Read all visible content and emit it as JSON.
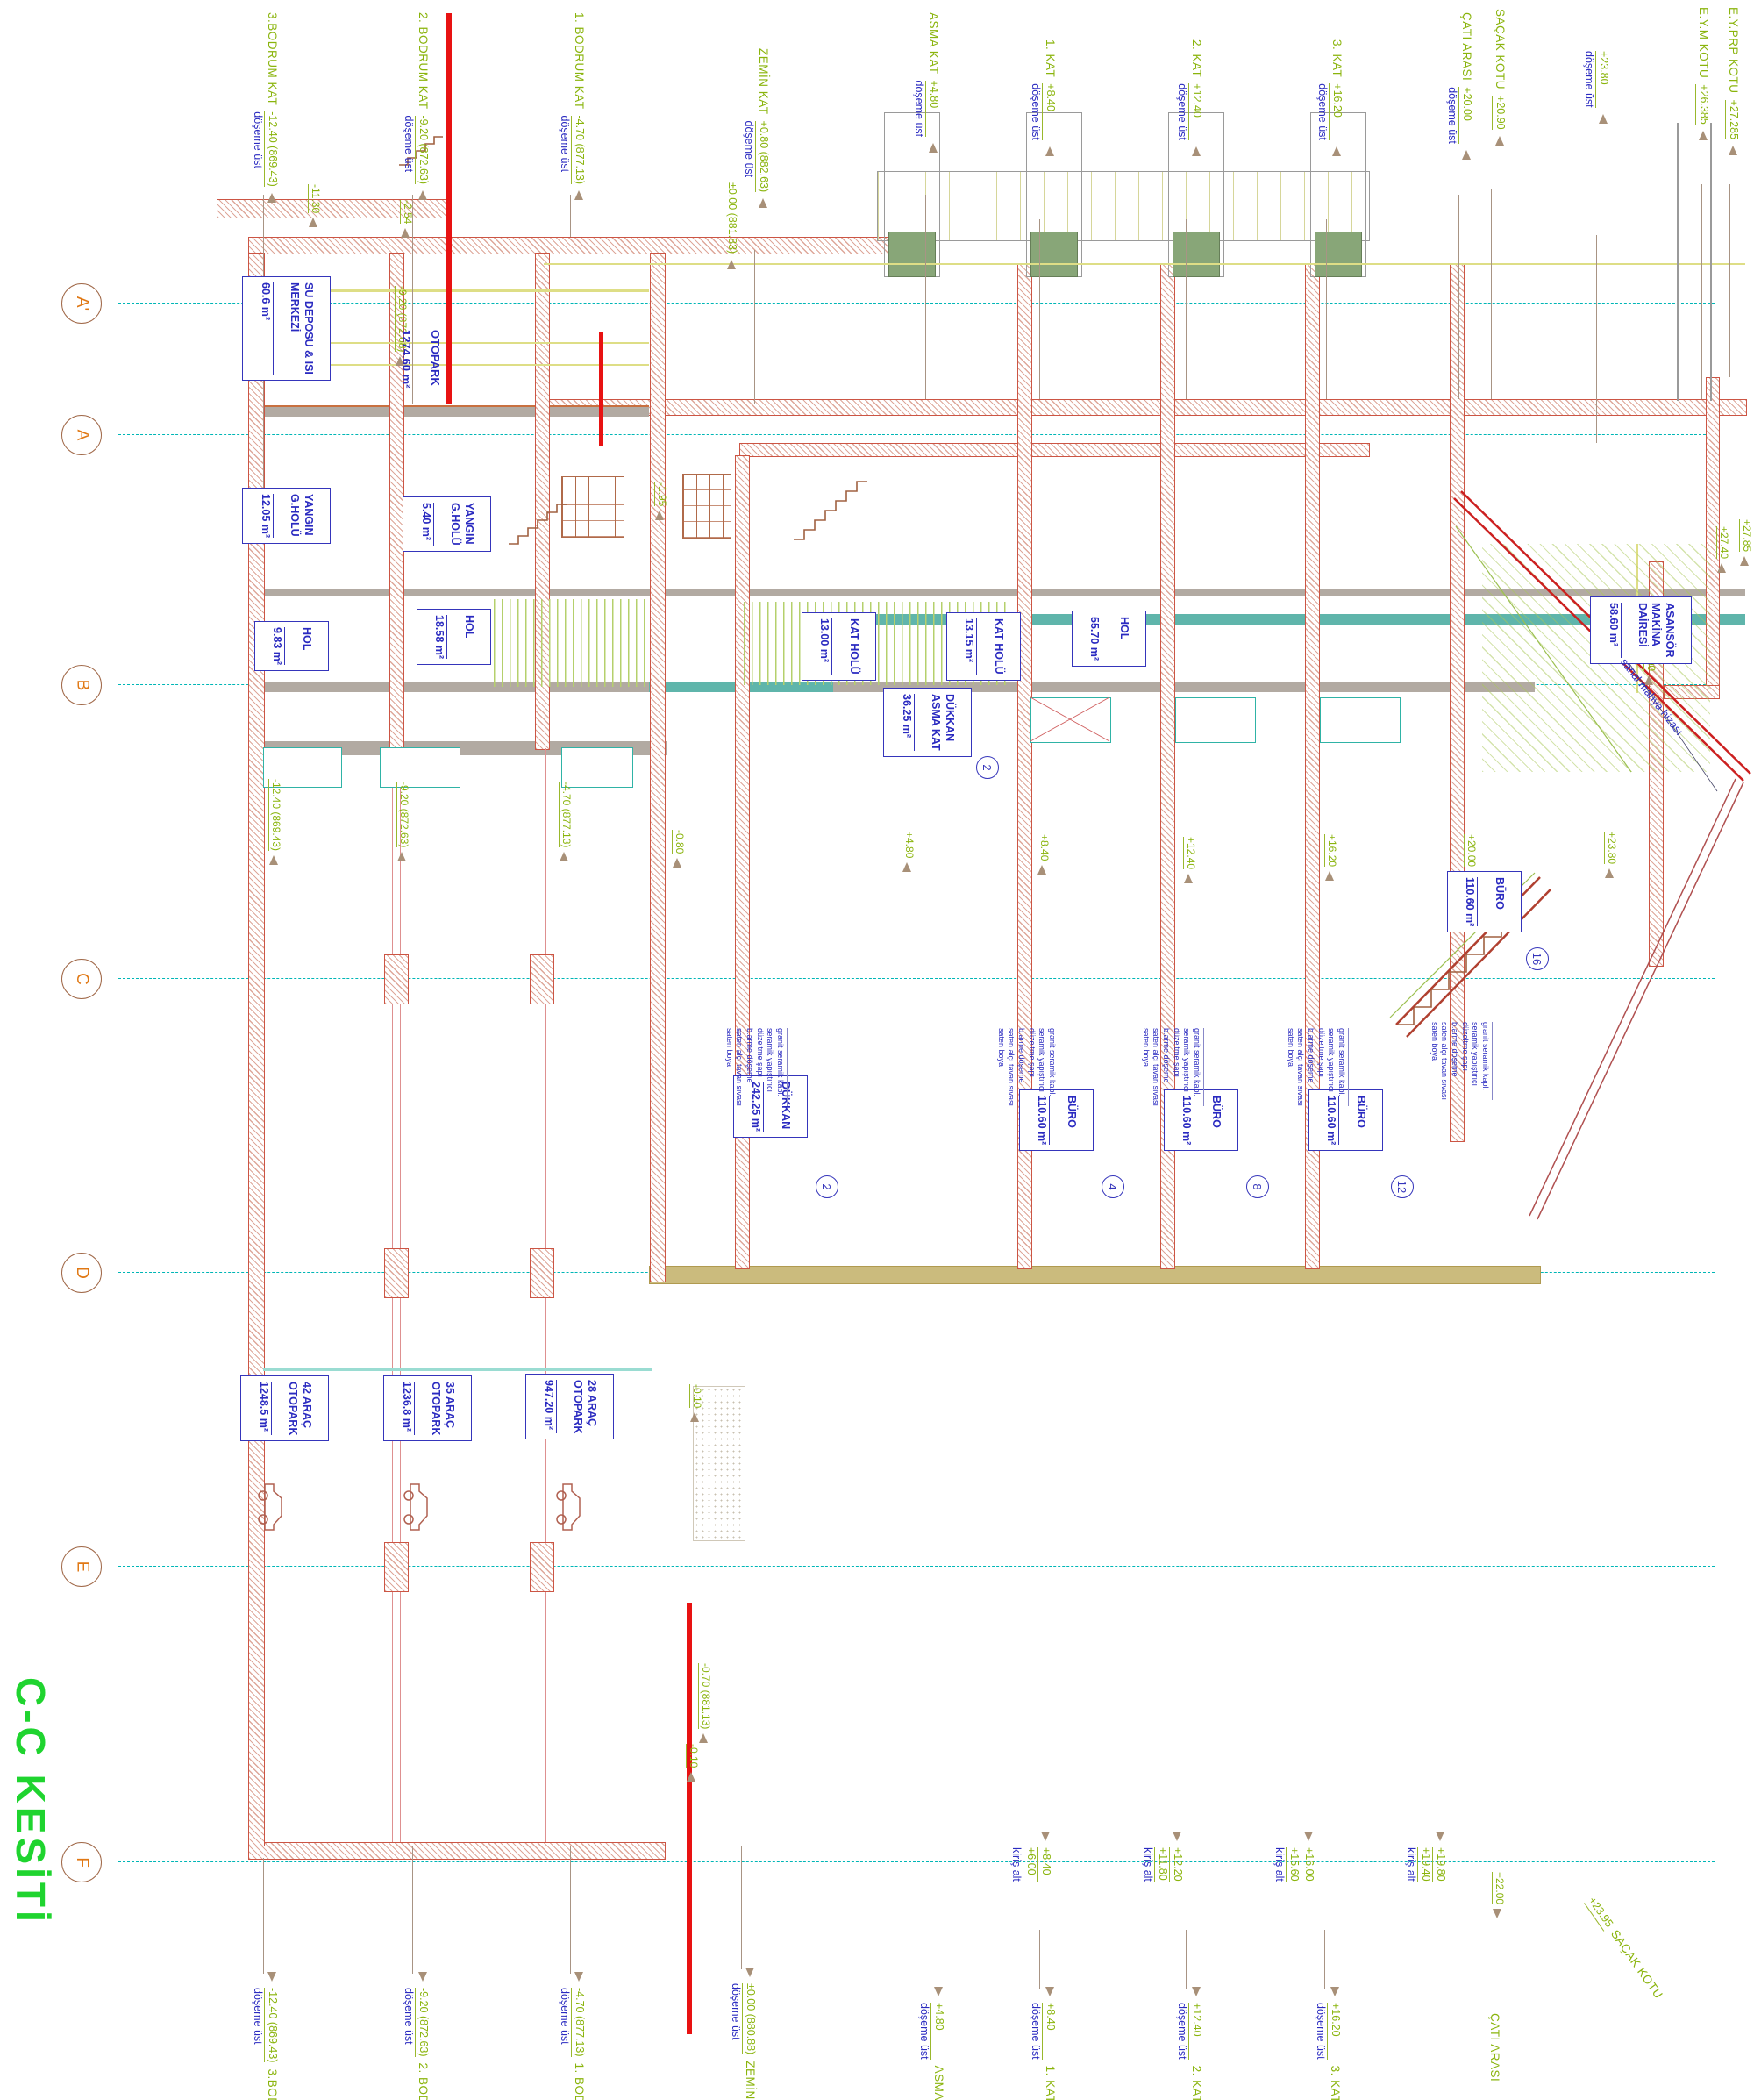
{
  "title": "C-C KESİTİ",
  "grid_axes": [
    "A'",
    "A",
    "B",
    "C",
    "D",
    "E",
    "F"
  ],
  "levels_top": [
    {
      "name": "3.BODRUM KAT",
      "sub": "döşeme üst",
      "elev": "-12.40 (869.43)"
    },
    {
      "name": "2. BODRUM KAT",
      "sub": "döşeme üst",
      "elev": "-9.20 (872.63)"
    },
    {
      "name": "1. BODRUM KAT",
      "sub": "döşeme üst",
      "elev": "-4.70 (877.13)"
    },
    {
      "name": "ZEMİN KAT",
      "sub": "döşeme üst",
      "elev": "+0.80 (882.63)"
    },
    {
      "name": "",
      "sub": "",
      "elev": "±0.00 (881.83)"
    },
    {
      "name": "ASMA KAT",
      "sub": "döşeme üst",
      "elev": "+4.80"
    },
    {
      "name": "1. KAT",
      "sub": "döşeme üst",
      "elev": "+8.40"
    },
    {
      "name": "2. KAT",
      "sub": "döşeme üst",
      "elev": "+12.40"
    },
    {
      "name": "3. KAT",
      "sub": "döşeme üst",
      "elev": "+16.20"
    },
    {
      "name": "ÇATI ARASI",
      "sub": "döşeme üst",
      "elev": "+20.00"
    },
    {
      "name": "SAÇAK KOTU",
      "sub": "",
      "elev": "+20.90"
    },
    {
      "name": "",
      "sub": "döşeme üst",
      "elev": "+23.80"
    },
    {
      "name": "E.Y.M KOTU",
      "sub": "",
      "elev": "+26.385"
    },
    {
      "name": "E.Y.PRP KOTU",
      "sub": "",
      "elev": "+27.285"
    }
  ],
  "levels_bottom": [
    {
      "elev": "-12.40 (869.43)",
      "sub": "döşeme üst",
      "name": "3.BODRUM KAT"
    },
    {
      "elev": "-9.20 (872.63)",
      "sub": "döşeme üst",
      "name": "2. BODRUM KAT"
    },
    {
      "elev": "-4.70 (877.13)",
      "sub": "döşeme üst",
      "name": "1. BODRUM KAT"
    },
    {
      "elev": "±0.00 (880.88)",
      "sub": "döşeme üst",
      "name": "ZEMİN KAT"
    },
    {
      "elev": "+4.80",
      "sub": "döşeme üst",
      "name": "ASMA KAT"
    },
    {
      "elev": "+8.40",
      "sub": "döşeme üst",
      "name": "1. KAT"
    },
    {
      "elev": "+12.40",
      "sub": "döşeme üst",
      "name": "2. KAT"
    },
    {
      "elev": "+16.20",
      "sub": "döşeme üst",
      "name": "3. KAT"
    },
    {
      "elev": "",
      "sub": "",
      "name": "ÇATI ARASI"
    },
    {
      "elev": "+23.95",
      "sub": "",
      "name": "SAÇAK KOTU"
    }
  ],
  "beams": [
    {
      "label": "kiriş alt",
      "v1": "+6.00",
      "v2": "+8.40"
    },
    {
      "label": "kiriş alt",
      "v1": "+11.80",
      "v2": "+12.20"
    },
    {
      "label": "kiriş alt",
      "v1": "+15.60",
      "v2": "+16.00"
    },
    {
      "label": "kiriş alt",
      "v1": "+19.40",
      "v2": "+19.80"
    }
  ],
  "spots": [
    "-11.30",
    "-2.54",
    "-9.20 (872.68)",
    "-1.95",
    "-12.40 (869.43)",
    "-9.20 (872.63)",
    "-4.70 (877.13)",
    "-0.80",
    "+4.80",
    "+8.40",
    "+12.40",
    "+16.20",
    "+20.00",
    "+23.80",
    "+25.00",
    "+27.85",
    "+27.40",
    "-0.10",
    "-0.70 (881.13)",
    "-0.10",
    "+22.00"
  ],
  "rooms": [
    {
      "name": "SU DEPOSU & ISI\nMERKEZİ",
      "area": "60.6 m²"
    },
    {
      "name": "OTOPARK",
      "area": "1274.60 m²"
    },
    {
      "name": "YANGIN\nG.HOLÜ",
      "area": "12.05 m²"
    },
    {
      "name": "YANGIN\nG.HOLÜ",
      "area": "5.40 m²"
    },
    {
      "name": "HOL",
      "area": "9.83 m²"
    },
    {
      "name": "HOL",
      "area": "18.58 m²"
    },
    {
      "name": "KAT HOLÜ",
      "area": "13.00 m²"
    },
    {
      "name": "KAT HOLÜ",
      "area": "13.15 m²"
    },
    {
      "name": "DÜKKAN\nASMA KAT",
      "area": "36.25 m²",
      "tag": "2"
    },
    {
      "name": "HOL",
      "area": "55.70 m²"
    },
    {
      "name": "ASANSÖR\nMAKİNA DAİRESİ",
      "area": "58.60 m²"
    },
    {
      "name": "BÜRO",
      "area": "110.60 m²",
      "tag": "16"
    },
    {
      "name": "DÜKKAN",
      "area": "242.25 m²",
      "tag": "2"
    },
    {
      "name": "BÜRO",
      "area": "110.60 m²",
      "tag": "4"
    },
    {
      "name": "BÜRO",
      "area": "110.60 m²",
      "tag": "8"
    },
    {
      "name": "BÜRO",
      "area": "110.60 m²",
      "tag": "12"
    },
    {
      "name": "42 ARAÇ\nOTOPARK",
      "area": "1248.5 m²"
    },
    {
      "name": "35 ARAÇ\nOTOPARK",
      "area": "1236.8 m²"
    },
    {
      "name": "28 ARAÇ\nOTOPARK",
      "area": "947.20 m²"
    }
  ],
  "finish_notes": "granit seramik kapl.\nseramik yapıştırıcı\ndüzeltme şapı\nb.arme döşeme\nsaten alçı tavan sıvası\nsaten boya",
  "annotations": {
    "sanal_mahya": "sanal mahya hizası"
  },
  "colors": {
    "accent_green": "#8ab40c",
    "title_green": "#1fd42f",
    "annotation_blue": "#2a2ac0",
    "grid_cyan": "#00b6b6",
    "axis_orange": "#e07814",
    "section_red": "#e81212"
  }
}
